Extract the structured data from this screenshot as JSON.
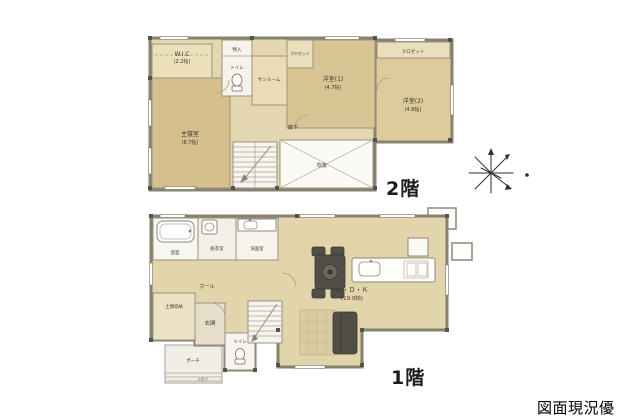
{
  "palette": {
    "room_fill": "#e2d4ab",
    "room_fill_dark": "#d5bf8c",
    "wall": "#87816F",
    "furniture_dark": "#514d47"
  },
  "floor2": {
    "label": "2階",
    "rooms": {
      "wic": {
        "name": "W.I.C",
        "size": "(2.2帖)"
      },
      "storage": {
        "name": "物入"
      },
      "toilet": {
        "name": "トイレ"
      },
      "sunroom": {
        "name": "サンルーム"
      },
      "closet1": {
        "name": "クロゼット"
      },
      "western1": {
        "name": "洋室(1)",
        "size": "(4.7帖)"
      },
      "closet2": {
        "name": "クロゼット"
      },
      "western2": {
        "name": "洋室(2)",
        "size": "(4.8帖)"
      },
      "master_bedroom": {
        "name": "主寝室",
        "size": "(8.7帖)"
      },
      "hallway": {
        "name": "廊下"
      },
      "void": {
        "name": "吹抜"
      }
    }
  },
  "floor1": {
    "label": "1階",
    "note": "※壁芯",
    "rooms": {
      "bath": {
        "name": "浴室"
      },
      "dressing": {
        "name": "脱衣室"
      },
      "washroom": {
        "name": "洗面室"
      },
      "hall": {
        "name": "ホール"
      },
      "doma_storage": {
        "name": "土間収納"
      },
      "entrance": {
        "name": "玄関"
      },
      "toilet": {
        "name": "トイレ"
      },
      "ldk": {
        "name": "Ｌ・Ｄ・Ｋ",
        "size": "(19.0帖)"
      },
      "porch": {
        "name": "ポーチ"
      }
    }
  },
  "annotation": {
    "disclaimer": "図面現況優先"
  }
}
